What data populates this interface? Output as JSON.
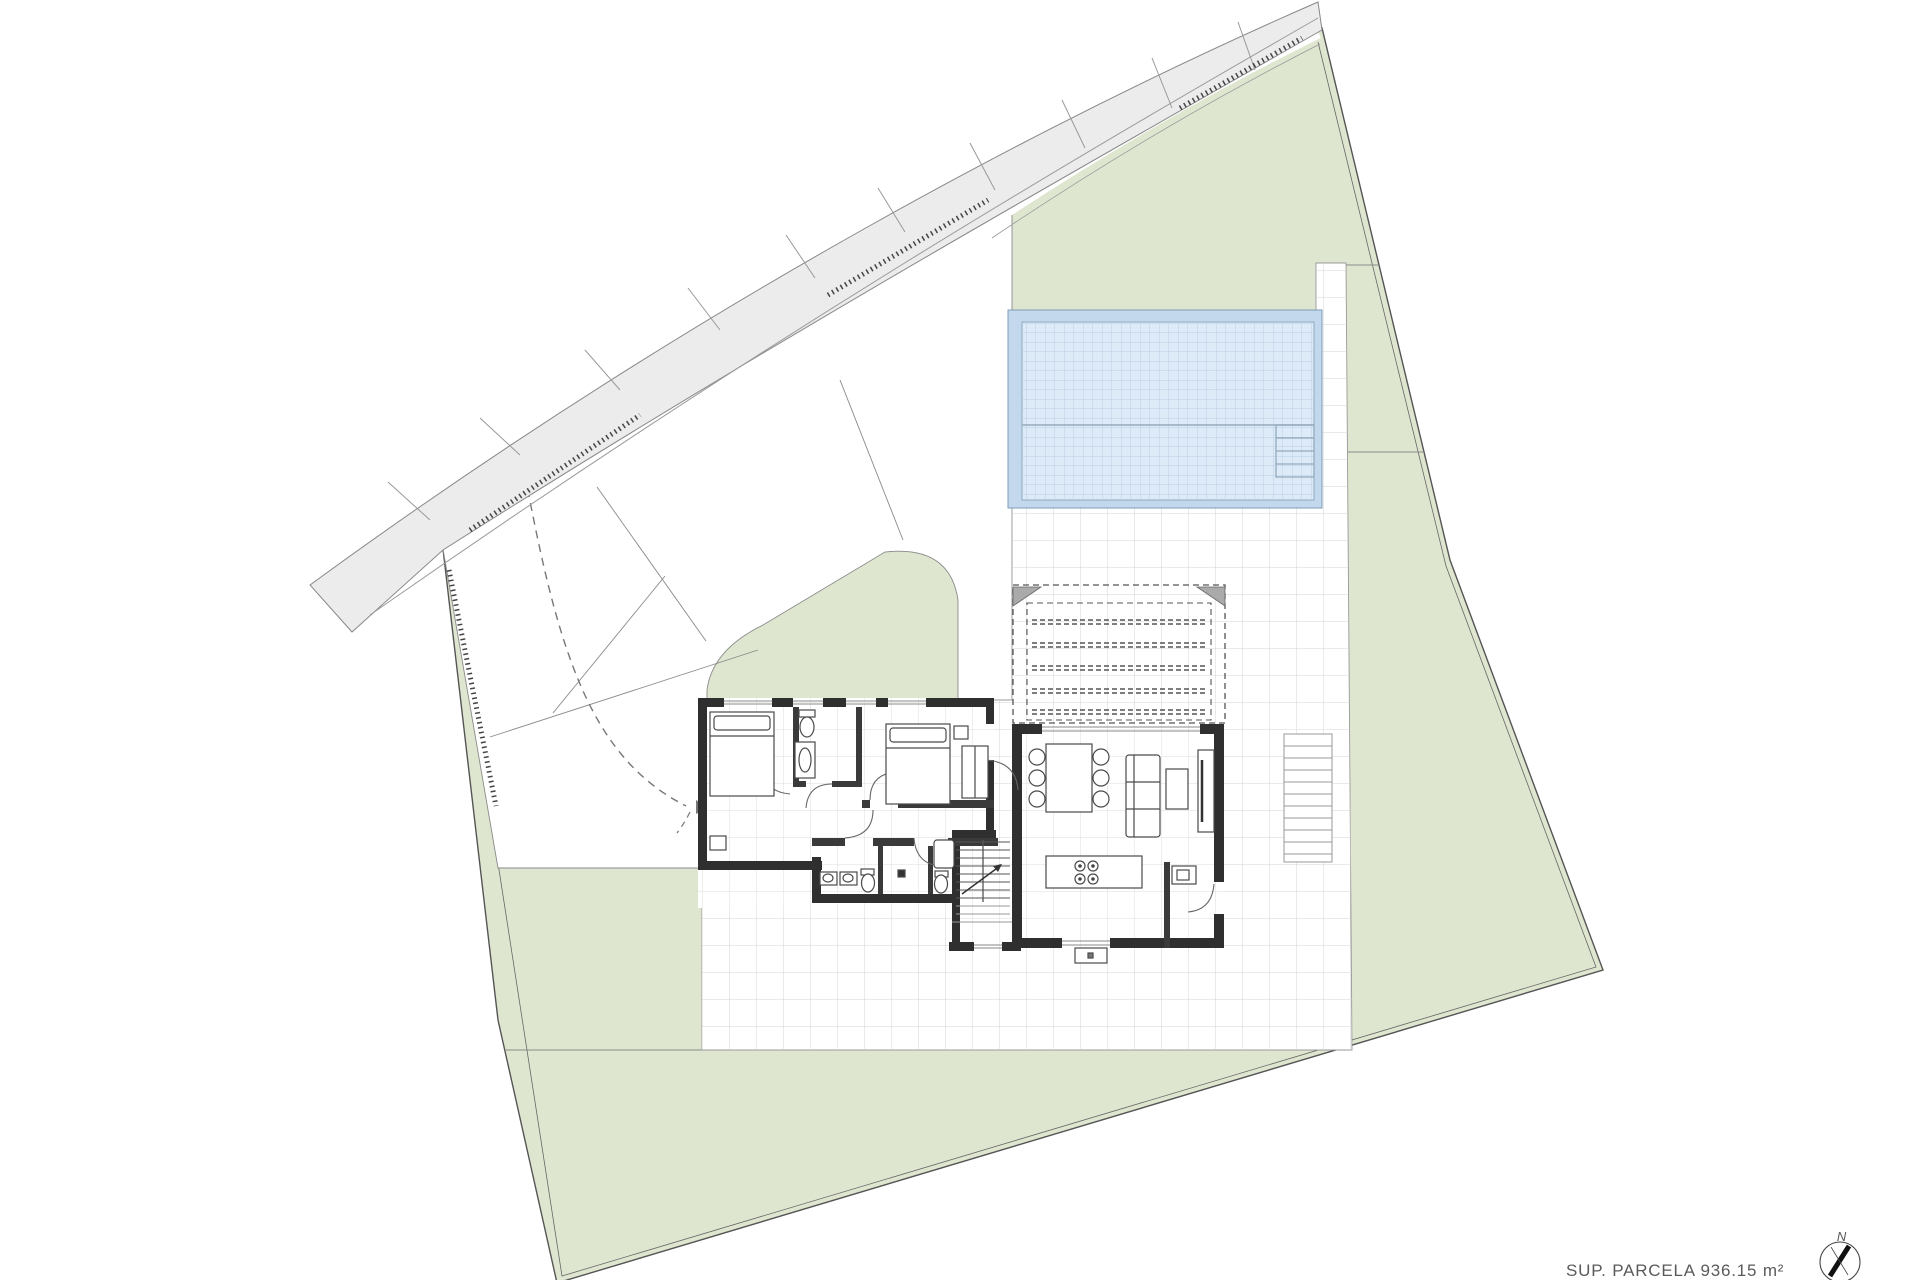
{
  "plan": {
    "footer": {
      "area_label": "SUP. PARCELA 936.15 m²"
    },
    "compass": {
      "north_label": "N"
    },
    "colors": {
      "green": "#dfe6d0",
      "road": "#ececec",
      "wall": "#2f2f2f",
      "deck": "#c3d8ec",
      "water": "#ddebf8",
      "pool_grid": "#b9cfe3",
      "terrace_grid": "#d4d4d4",
      "boundary": "#555555",
      "text": "#5a5a5a"
    }
  }
}
